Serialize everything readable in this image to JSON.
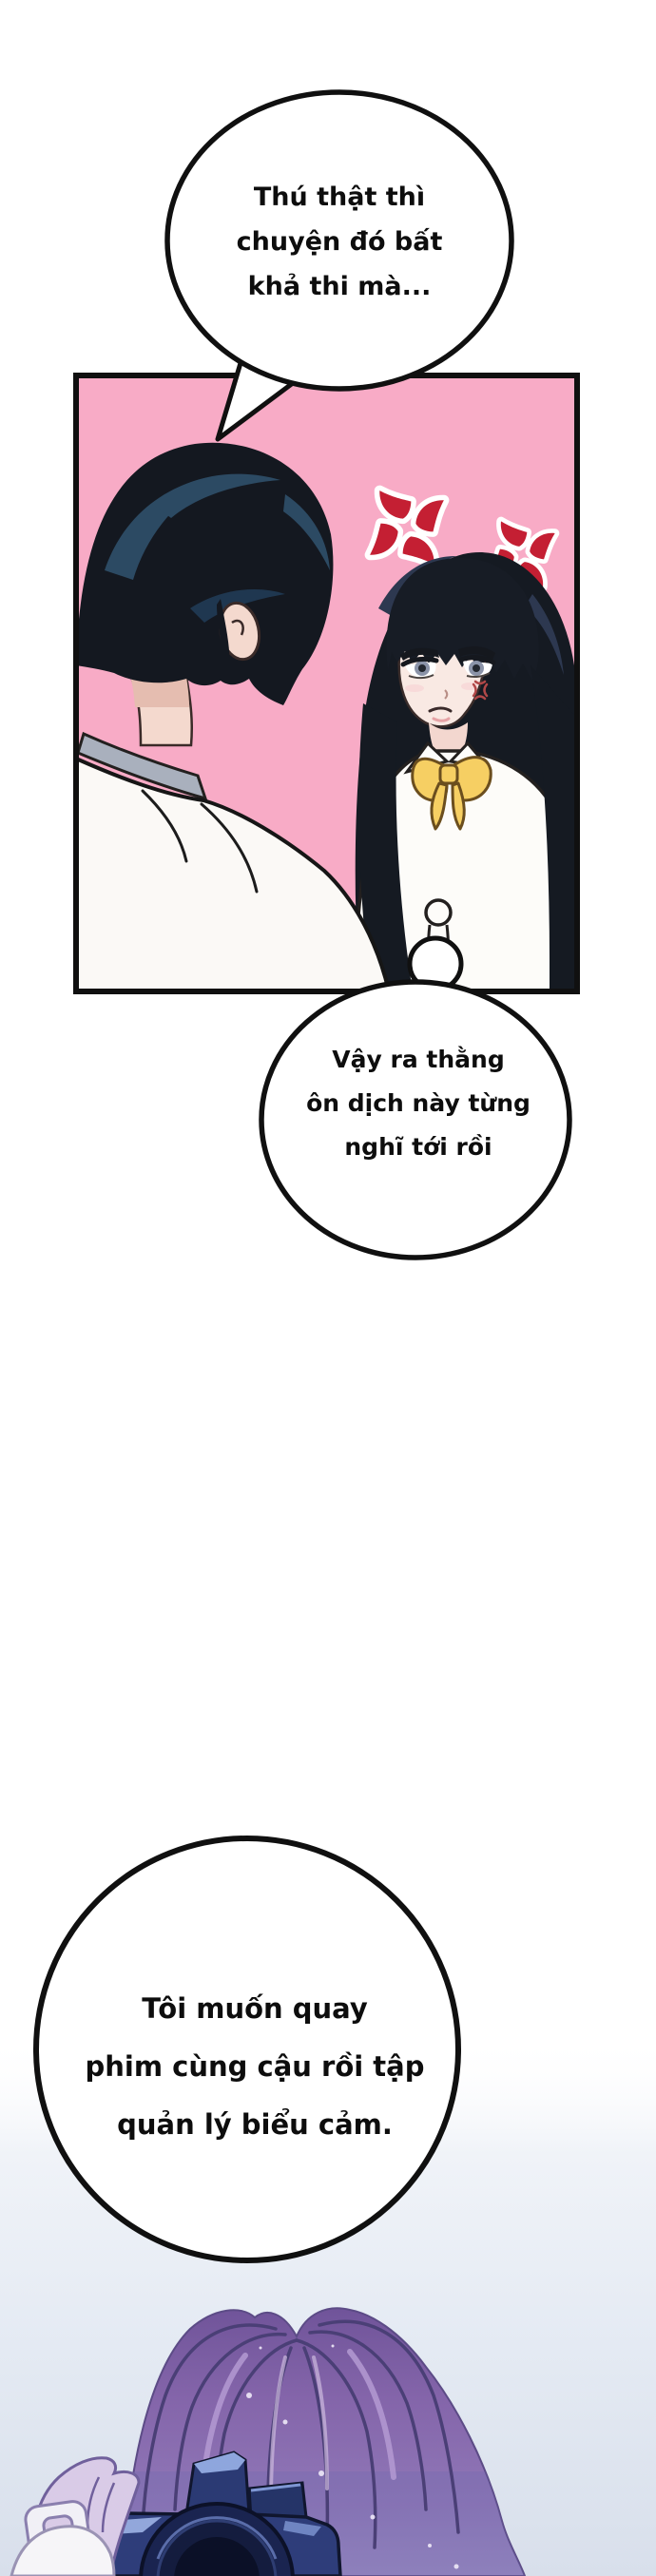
{
  "bubbles": {
    "bubble1": {
      "line1": "Thú thật thì",
      "line2": "chuyện đó bất",
      "line3": "khả thi mà..."
    },
    "bubble2": {
      "line1": "Vậy ra thằng",
      "line2": "ôn dịch này từng",
      "line3": "nghĩ tới rồi"
    },
    "bubble3": {
      "line1": "Tôi muốn quay",
      "line2": "phim cùng cậu rồi tập",
      "line3": "quản lý biểu cảm."
    }
  },
  "colors": {
    "panel_pink": "#f8abc6",
    "anger_red": "#c41f33",
    "bow_yellow": "#f6cf63",
    "hair_purple": "#8465aa",
    "camera_navy": "#2e3d7a",
    "hand_lavender": "#d9cbe7",
    "bg_gradient_bottom": "#d8dfeb",
    "outline_black": "#101010"
  }
}
